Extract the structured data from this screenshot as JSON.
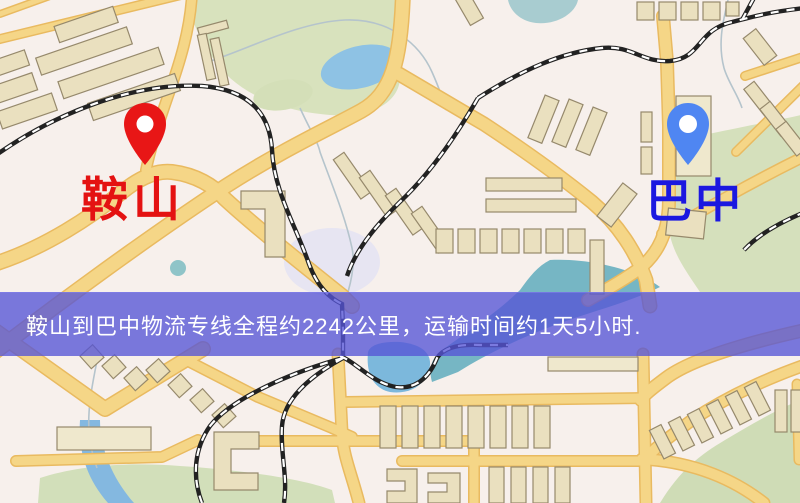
{
  "map_view": {
    "origin_marker": {
      "label": "鞍山",
      "pin_color": "#e81616",
      "label_color": "#e41212"
    },
    "destination_marker": {
      "label": "巴中",
      "pin_color": "#4f86f2",
      "label_color": "#1b18e0"
    },
    "info_banner": {
      "text": "鞍山到巴中物流专线全程约2242公里，运输时间约1天5小时.",
      "background_color": "rgba(86,84,214,0.78)",
      "text_color": "#ffffff"
    }
  }
}
